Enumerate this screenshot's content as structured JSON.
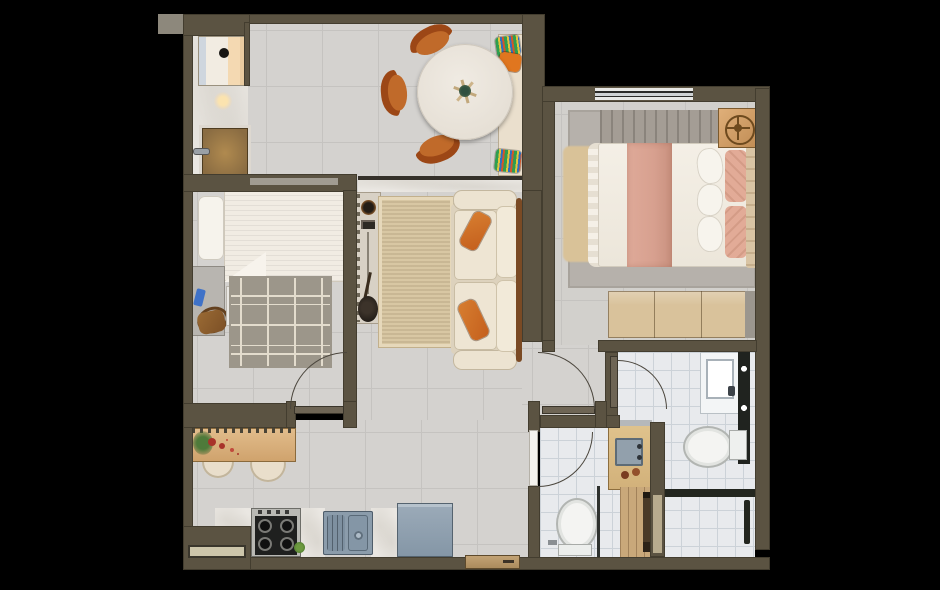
{
  "scene": {
    "kind": "apartment-floor-plan-render",
    "view": "top-down",
    "rooms": [
      {
        "id": "entry-laundry",
        "furniture": [
          "washing-machine",
          "entry-door",
          "ceiling-light",
          "marble-floor"
        ]
      },
      {
        "id": "dining-room",
        "furniture": [
          "round-table",
          "plant-centerpiece",
          "wood-chair-top",
          "wood-chair-left",
          "wood-chair-bottom",
          "bench-seat",
          "striped-pillow-top",
          "orange-pillow",
          "striped-pillow-bottom"
        ]
      },
      {
        "id": "living-room",
        "furniture": [
          "sideboard",
          "media-rack",
          "speaker",
          "guitar",
          "jute-rug",
          "sofa",
          "orange-lumbar-pillow-1",
          "orange-lumbar-pillow-2"
        ]
      },
      {
        "id": "bedroom-small",
        "furniture": [
          "single-bed",
          "pillow",
          "desk",
          "bag",
          "phone",
          "white-nightstand",
          "geometric-rug",
          "door"
        ]
      },
      {
        "id": "bedroom-main",
        "furniture": [
          "double-bed",
          "pink-runner",
          "white-pillows",
          "pink-pillows",
          "headboard",
          "nightstand",
          "wheel-decor",
          "gray-rug",
          "beige-rug",
          "wardrobe",
          "window",
          "door"
        ]
      },
      {
        "id": "kitchen",
        "furniture": [
          "breakfast-bar",
          "flowers",
          "stool-1",
          "stool-2",
          "stove",
          "double-sink",
          "refrigerator",
          "marble-counter",
          "service-door",
          "planter"
        ]
      },
      {
        "id": "bathroom-1",
        "furniture": [
          "toilet",
          "wood-vanity",
          "sink",
          "soaps",
          "shower",
          "glass-partition",
          "white-door"
        ]
      },
      {
        "id": "bathroom-2",
        "furniture": [
          "toilet",
          "vanity-sink",
          "towel-shelf",
          "towel-bar",
          "shower",
          "glass-partition",
          "door"
        ]
      }
    ]
  },
  "palette": {
    "bg": "#000000",
    "wall": "#5b5342",
    "wallEdge": "#2e2a22",
    "floor": "#d4d2cf",
    "grout": "#c5c3c0",
    "floorBed2": "#d2d0cc",
    "bathFloor": "#e8eaed",
    "bathGrout": "#ccd2d8",
    "marble": "#eae7e2",
    "woodBar": "#d6ad7b",
    "woodDoor": "#8a6c42",
    "woodWardrobe": "#d9c29b",
    "woodVanity": "#d2b17a",
    "doorLeaf": "#6e6555",
    "arc": "#4b463d",
    "linen": "#f1ece3",
    "linenStripe": "#e4ddd0",
    "pink": "#d7a08f",
    "pinkPillow": "#e2ab97",
    "orange": "#c45f1d",
    "sofa": "#ece3d1",
    "rugJute": "#d8c7a3",
    "rugGray": "#9c968a",
    "rugLine": "#e3dccd",
    "rugGray2": "#b6b1ab",
    "beigeRug": "#d9c298",
    "appliance": "#8b9cab",
    "applianceDark": "#23262a",
    "white": "#f4f3f0",
    "glass": "#23261f",
    "green": "#4e7a3a",
    "red": "#a8332a",
    "blue": "#3f72c8",
    "bagBrown": "#7c5026",
    "chairWood": "#9c4716",
    "chairSeat": "#c06a2a",
    "headboardTan": "#d9c4a4"
  }
}
